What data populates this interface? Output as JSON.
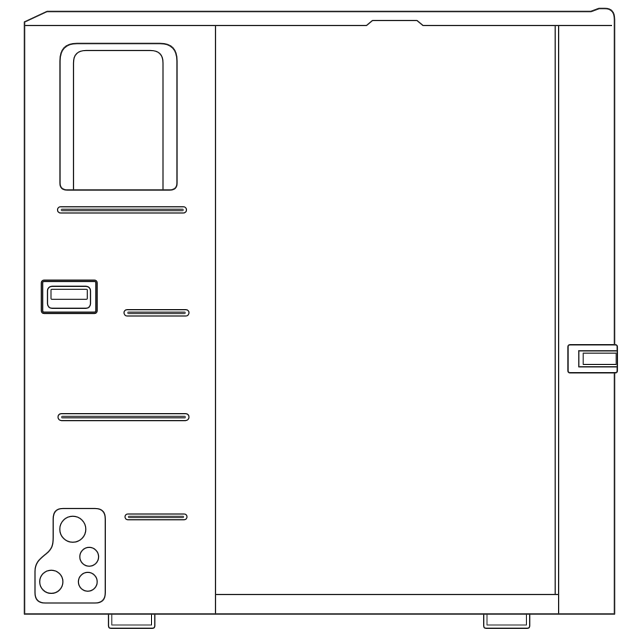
{
  "drawing": {
    "kind": "technical-line-drawing",
    "background_color": "#ffffff",
    "line_color": "#1f1f1f",
    "slot_band_color": "#4d4d4d",
    "fill_color": "#ffffff",
    "components": [
      {
        "name": "chassis-outline",
        "count": 1
      },
      {
        "name": "top-cover-seam-with-tab-notch",
        "count": 1
      },
      {
        "name": "left-panel-divider",
        "count": 1
      },
      {
        "name": "door-edge-lines",
        "count": 2
      },
      {
        "name": "door-bottom-edge",
        "count": 1
      },
      {
        "name": "rounded-window-cutout",
        "count": 1
      },
      {
        "name": "vent-slot",
        "count": 4
      },
      {
        "name": "rectangular-port",
        "count": 1
      },
      {
        "name": "connector-cluster-hole",
        "count": 4
      },
      {
        "name": "side-latch",
        "count": 1
      },
      {
        "name": "foot",
        "count": 2
      }
    ]
  }
}
